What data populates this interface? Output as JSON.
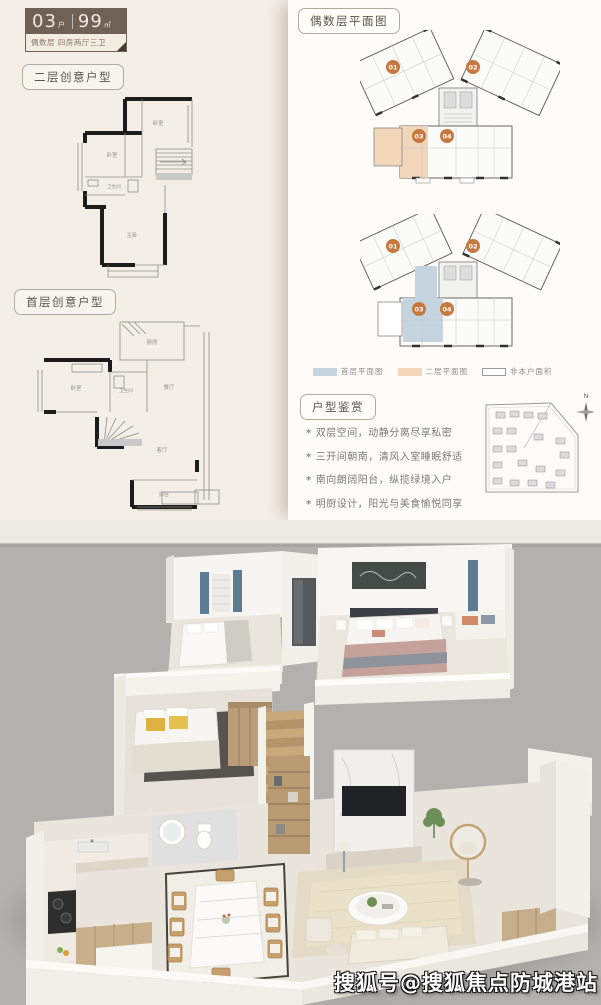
{
  "badge": {
    "unit_number": "03",
    "unit_suffix": "户",
    "area": "99",
    "area_unit": "㎡",
    "subtitle": "偶数层 四房两厅三卫"
  },
  "left_column": {
    "floor2_tag": "二层创意户型",
    "floor1_tag": "首层创意户型",
    "floor2_rooms": {
      "bedroom_top": "卧室",
      "bedroom_mid": "卧室",
      "bathroom": "卫生间",
      "master": "主卧"
    },
    "floor1_rooms": {
      "kitchen": "厨房",
      "bedroom": "卧室",
      "bathroom": "卫生间",
      "dining": "餐厅",
      "living": "客厅",
      "balcony": "阳台"
    }
  },
  "right_panel": {
    "title_tag": "偶数层平面图",
    "badges": [
      "01",
      "02",
      "03",
      "04"
    ],
    "legend": [
      {
        "label": "首层平面图",
        "color": "#c5d4de"
      },
      {
        "label": "二层平面图",
        "color": "#f2d6ba"
      },
      {
        "label": "非本户面积",
        "color": "#ffffff"
      }
    ],
    "appreciation": {
      "tag": "户型鉴赏",
      "bullet_glyph": "*",
      "bullets": [
        "双层空间，动静分离尽享私密",
        "三开间朝南，清风入室睡眠舒适",
        "南向朗阔阳台，纵揽绿境入户",
        "明厨设计，阳光与美食愉悦同享"
      ]
    },
    "compass_label": "N"
  },
  "watermark": "搜狐号@搜狐焦点防城港站",
  "colors": {
    "accent_orange": "#c6793f",
    "highlight_peach": "#f2d6ba",
    "highlight_blue": "#c5d4de",
    "badge_brown": "#6f6156",
    "page_cream": "#f4efe6",
    "panel_white": "#fdfcf8",
    "render_bg": "#b2b1ae"
  }
}
